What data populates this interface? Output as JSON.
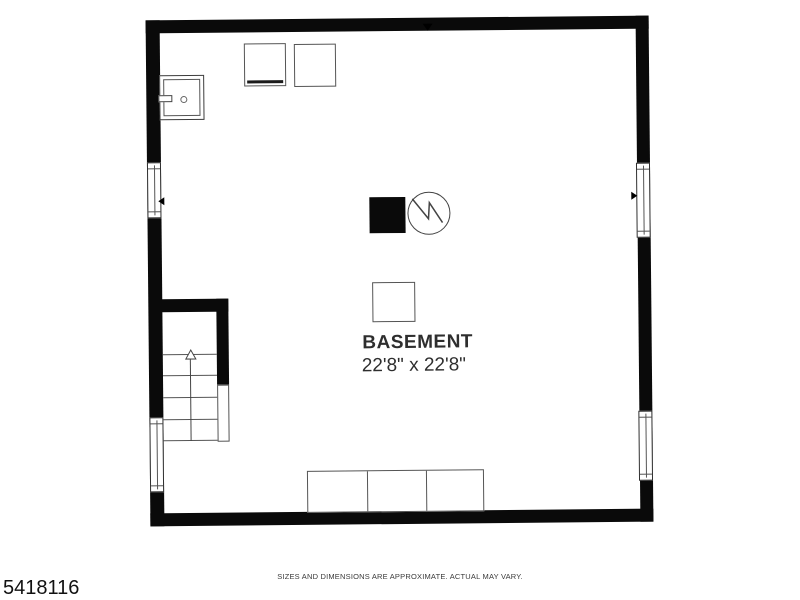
{
  "page": {
    "background": "#ffffff"
  },
  "plan": {
    "room_label": "BASEMENT",
    "dimensions": "22'8\" x 22'8\"",
    "colors": {
      "wall": "#0a0a0a",
      "fixture_outline": "#555555",
      "text": "#2e2e2e"
    },
    "fixtures": [
      "utility-sink",
      "washer",
      "dryer",
      "furnace",
      "water-heater",
      "sump-pit",
      "staircase-up",
      "storage-shelves"
    ],
    "window_count": 4
  },
  "footer": {
    "listing_id": "5418116",
    "disclaimer": "SIZES AND DIMENSIONS ARE APPROXIMATE. ACTUAL MAY VARY."
  }
}
